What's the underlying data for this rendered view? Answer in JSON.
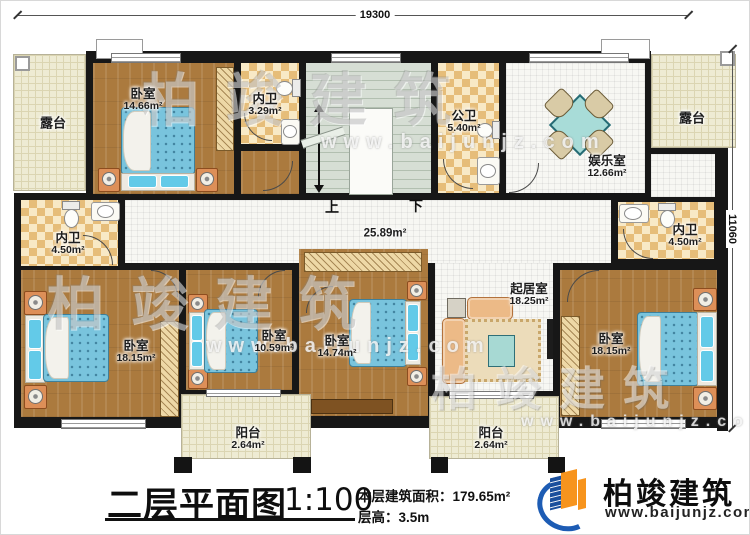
{
  "plan": {
    "dim_top": "19300",
    "dim_right": "11060",
    "hall_area": "25.89m²",
    "stairs_up": "上",
    "stairs_down": "下"
  },
  "rooms": {
    "terrace_left": {
      "name": "露台"
    },
    "bedroom_top_left": {
      "name": "卧室",
      "area": "14.66m²"
    },
    "bath_top": {
      "name": "内卫",
      "area": "3.29m²"
    },
    "bath_public": {
      "name": "公卫",
      "area": "5.40m²"
    },
    "entertainment": {
      "name": "娱乐室",
      "area": "12.66m²"
    },
    "terrace_right": {
      "name": "露台"
    },
    "bath_left": {
      "name": "内卫",
      "area": "4.50m²"
    },
    "bath_right": {
      "name": "内卫",
      "area": "4.50m²"
    },
    "bedroom_bottom_left": {
      "name": "卧室",
      "area": "18.15m²"
    },
    "bedroom_bottom_mid1": {
      "name": "卧室",
      "area": "10.59m²"
    },
    "bedroom_bottom_mid2": {
      "name": "卧室",
      "area": "14.74m²"
    },
    "living": {
      "name": "起居室",
      "area": "18.25m²"
    },
    "bedroom_bottom_right": {
      "name": "卧室",
      "area": "18.15m²"
    },
    "balcony_left": {
      "name": "阳台",
      "area": "2.64m²"
    },
    "balcony_right": {
      "name": "阳台",
      "area": "2.64m²"
    }
  },
  "title_block": {
    "title": "二层平面图",
    "scale": "1:100",
    "floor_area": "本层建筑面积：179.65m²",
    "floor_height": "层高：3.5m"
  },
  "logo": {
    "company": "柏竣建筑",
    "website": "www.baijunjz.com"
  },
  "watermark": {
    "text": "柏竣建筑",
    "site": "www.baijunjz.com"
  },
  "colors": {
    "wall": "#171717",
    "wood": "#ab7a3e",
    "tile": "#f7f7f3",
    "checker": "#e6bd79",
    "terrace": "#eeebd3",
    "bed": "#79c4dd",
    "accent_blue": "#1d5cb4",
    "accent_orange": "#f7941d"
  }
}
